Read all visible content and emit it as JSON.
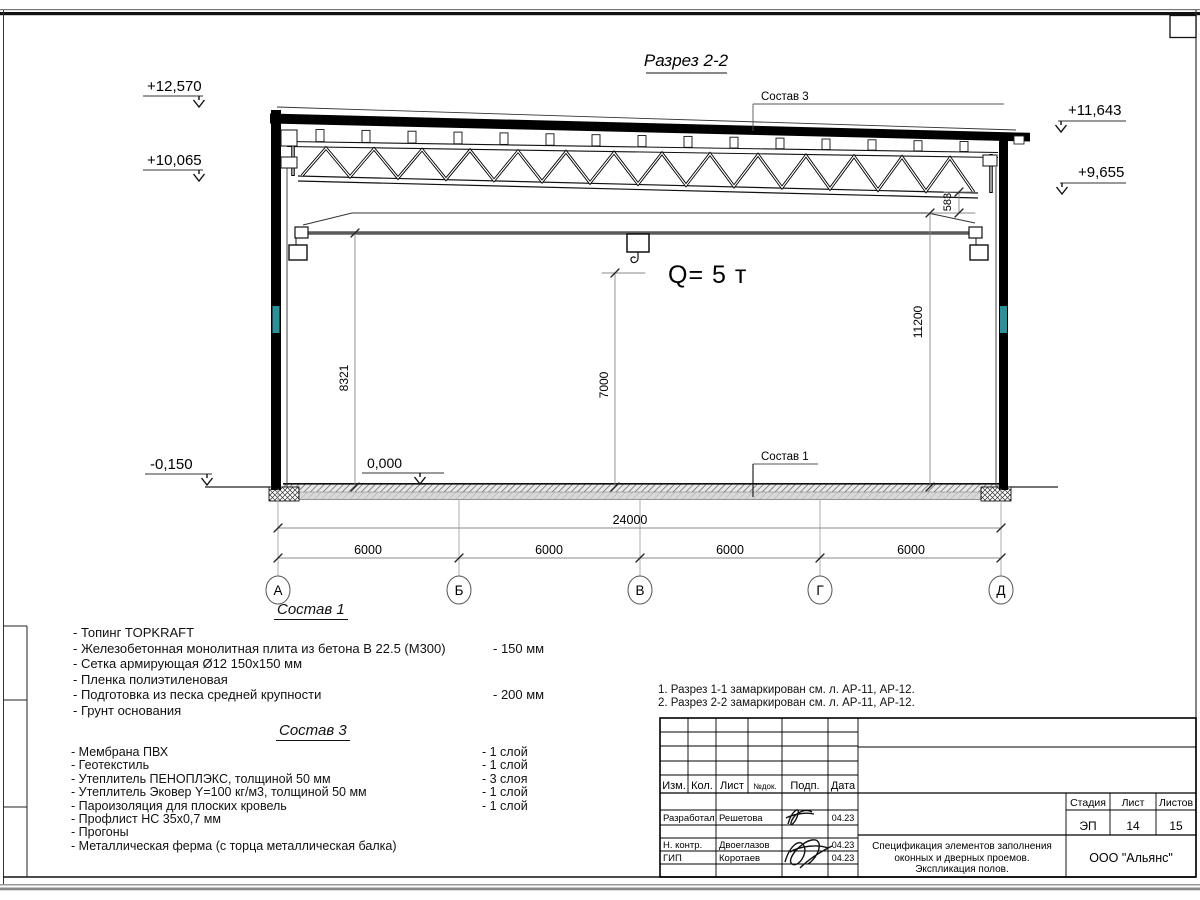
{
  "drawing": {
    "title": "Разрез 2-2",
    "crane_label": "Q= 5 т",
    "elevation_marks": {
      "left_top": "+12,570",
      "left_mid": "+10,065",
      "left_bottom": "-0,150",
      "right_top": "+11,643",
      "right_mid": "+9,655",
      "floor": "0,000"
    },
    "dims": {
      "crane_rail_height": "8321",
      "hook_height": "7000",
      "right_height": "11200",
      "truss_offset": "583",
      "total_span": "24000",
      "bays": [
        "6000",
        "6000",
        "6000",
        "6000"
      ]
    },
    "axes": [
      "А",
      "Б",
      "В",
      "Г",
      "Д"
    ],
    "leaders": {
      "roof": "Состав 3",
      "floor": "Состав 1"
    }
  },
  "sostav1": {
    "heading": "Состав 1",
    "items": [
      {
        "text": "- Топинг TOPKRAFT",
        "value": ""
      },
      {
        "text": "- Железобетонная  монолитная плита из бетона  В 22.5 (М300)",
        "value": "- 150 мм"
      },
      {
        "text": "- Сетка армирующая Ø12 150х150 мм",
        "value": ""
      },
      {
        "text": "- Пленка полиэтиленовая",
        "value": ""
      },
      {
        "text": "- Подготовка из песка средней  крупности",
        "value": "- 200 мм"
      },
      {
        "text": "- Грунт основания",
        "value": ""
      }
    ]
  },
  "sostav3": {
    "heading": "Состав 3",
    "items": [
      {
        "text": "- Мембрана ПВХ",
        "value": "- 1 слой"
      },
      {
        "text": "- Геотекстиль",
        "value": "- 1 слой"
      },
      {
        "text": "- Утеплитель ПЕНОПЛЭКС, толщиной 50 мм",
        "value": "- 3 слоя"
      },
      {
        "text": "- Утеплитель Эковер Y=100 кг/м3, толщиной 50 мм",
        "value": "- 1 слой"
      },
      {
        "text": "- Пароизоляция для плоских кровель",
        "value": "- 1 слой"
      },
      {
        "text": "- Профлист НС 35х0,7 мм",
        "value": ""
      },
      {
        "text": "- Прогоны",
        "value": ""
      },
      {
        "text": "- Металлическая ферма (с торца металлическая балка)",
        "value": ""
      }
    ]
  },
  "notes": {
    "line1": "1. Разрез 1-1 замаркирован см. л. АР-11, АР-12.",
    "line2": "2. Разрез 2-2 замаркирован см. л. АР-11, АР-12."
  },
  "stamp": {
    "cols": [
      "Изм.",
      "Кол.",
      "Лист",
      "№док.",
      "Подп.",
      "Дата"
    ],
    "rows": [
      {
        "role": "Разработал",
        "name": "Решетова",
        "date": "04.23"
      },
      {
        "role": "Н. контр.",
        "name": "Двоеглазов",
        "date": "04.23"
      },
      {
        "role": "ГИП",
        "name": "Коротаев",
        "date": "04.23"
      }
    ],
    "stage_label": "Стадия",
    "sheet_label": "Лист",
    "sheets_label": "Листов",
    "stage": "ЭП",
    "sheet": "14",
    "sheets": "15",
    "doc_title_lines": [
      "Спецификация элементов заполнения",
      "оконных и дверных проемов.",
      "Экспликация полов."
    ],
    "company": "ООО \"Альянс\""
  }
}
